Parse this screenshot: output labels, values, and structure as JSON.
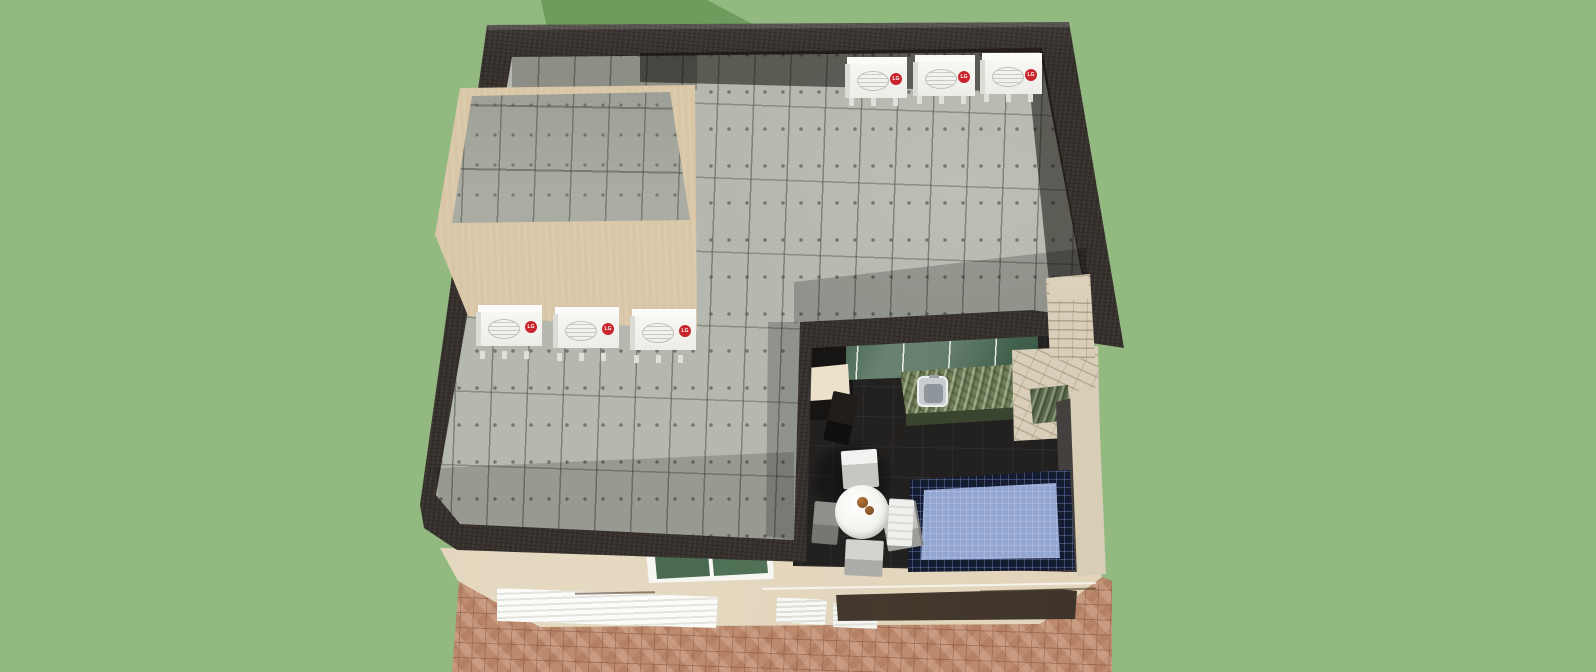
{
  "scene": {
    "type": "3d-architectural-model-render",
    "view": "aerial-overhead",
    "subject": "two-story-house-with-rooftop-terrace-and-courtyard",
    "colors": {
      "sky": "#92B980",
      "backdrop_hill": "#6E9C5D"
    }
  },
  "building": {
    "roof_terrace": {
      "parapet_color": "#36302C",
      "deck_material": "concrete-panels",
      "deck_color": "#B5B8AE",
      "stair_bulkhead": {
        "wall_color": "#D9C6A6",
        "roof_material": "concrete-panels"
      }
    },
    "facade": {
      "wall_color": "#E2D5BC",
      "window": {
        "frame_color": "#F6F6F3",
        "glass_color": "#3A5A46",
        "panes": 2
      },
      "garage_doors": {
        "count": 3,
        "color": "#F2F2EF",
        "style": "roller-slat"
      }
    },
    "driveway": {
      "material": "brick-pavers",
      "color": "#BD8A6D"
    }
  },
  "hvac": {
    "brand": "LG",
    "unit_count": 6,
    "badge_color": "#C8242B",
    "groups": [
      {
        "location": "north-parapet-row",
        "count": 3
      },
      {
        "location": "west-bulkhead-row",
        "count": 3
      }
    ]
  },
  "courtyard": {
    "floor_color": "#232020",
    "pool": {
      "water_color": "#93A6D2",
      "tile_border_color": "#151B30"
    },
    "outdoor_kitchen": {
      "counter_material": "green-granite",
      "counter_color": "#72805A",
      "sink_material": "stainless-steel",
      "glass_wall_color": "#3E5C48",
      "barbecue_material": "stacked-stone",
      "barbecue_color": "#D9CEB9"
    },
    "furniture": {
      "dining_table": {
        "shape": "round",
        "color": "#FFFFFF",
        "tabletop_items": "fruit"
      },
      "chair_count": 5,
      "sun_lounger_count": 1
    }
  }
}
